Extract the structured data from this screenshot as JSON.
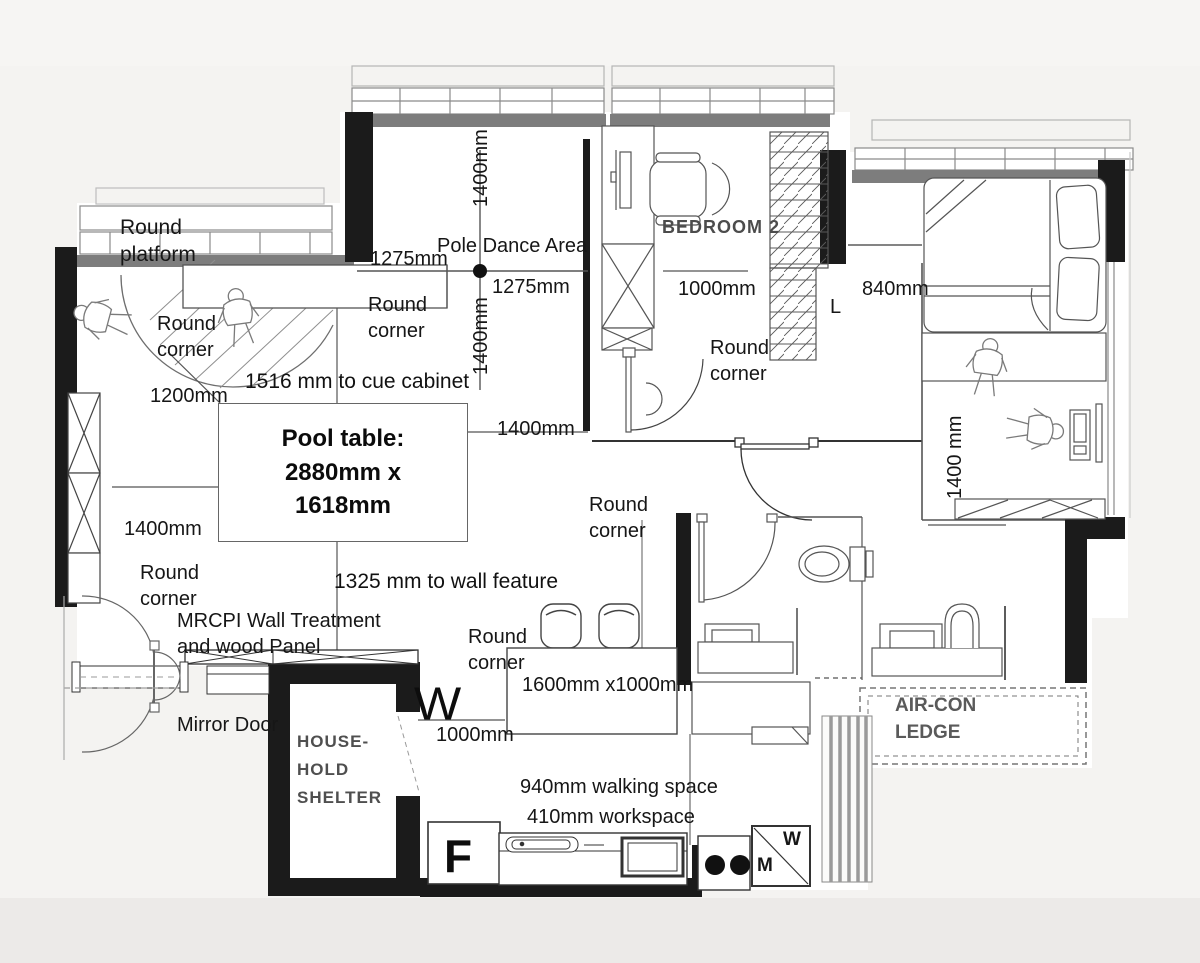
{
  "labels": {
    "round_platform": "Round platform",
    "round_corner": "Round corner",
    "pole_dance_area": "Pole Dance Area",
    "cue_cabinet_note": "1516 mm to cue cabinet",
    "wall_feature_note": "1325 mm to wall feature",
    "mrcpi_line1": "MRCPI  Wall Treatment",
    "mrcpi_line2": "and wood Panel",
    "mirror_door": "Mirror Door",
    "walking_space": "940mm walking space",
    "workspace": "410mm workspace",
    "dining_size": "1600mm x1000mm"
  },
  "dimensions": {
    "d1275": "1275mm",
    "d1400": "1400mm",
    "d1400_spaced": "1400 mm",
    "d1200": "1200mm",
    "d1000": "1000mm",
    "d840": "840mm"
  },
  "pool_table": {
    "line1": "Pool table:",
    "line2": "2880mm x",
    "line3": "1618mm"
  },
  "rooms": {
    "bedroom2": "BEDROOM 2",
    "household_shelter": [
      "HOUSE-",
      "HOLD",
      "SHELTER"
    ],
    "aircon_ledge": [
      "AIR-CON",
      "LEDGE"
    ]
  },
  "markers": {
    "fridge": "F",
    "washer_w": "W",
    "washer_m": "M",
    "wardrobe_w": "W",
    "switch_l": "L"
  }
}
